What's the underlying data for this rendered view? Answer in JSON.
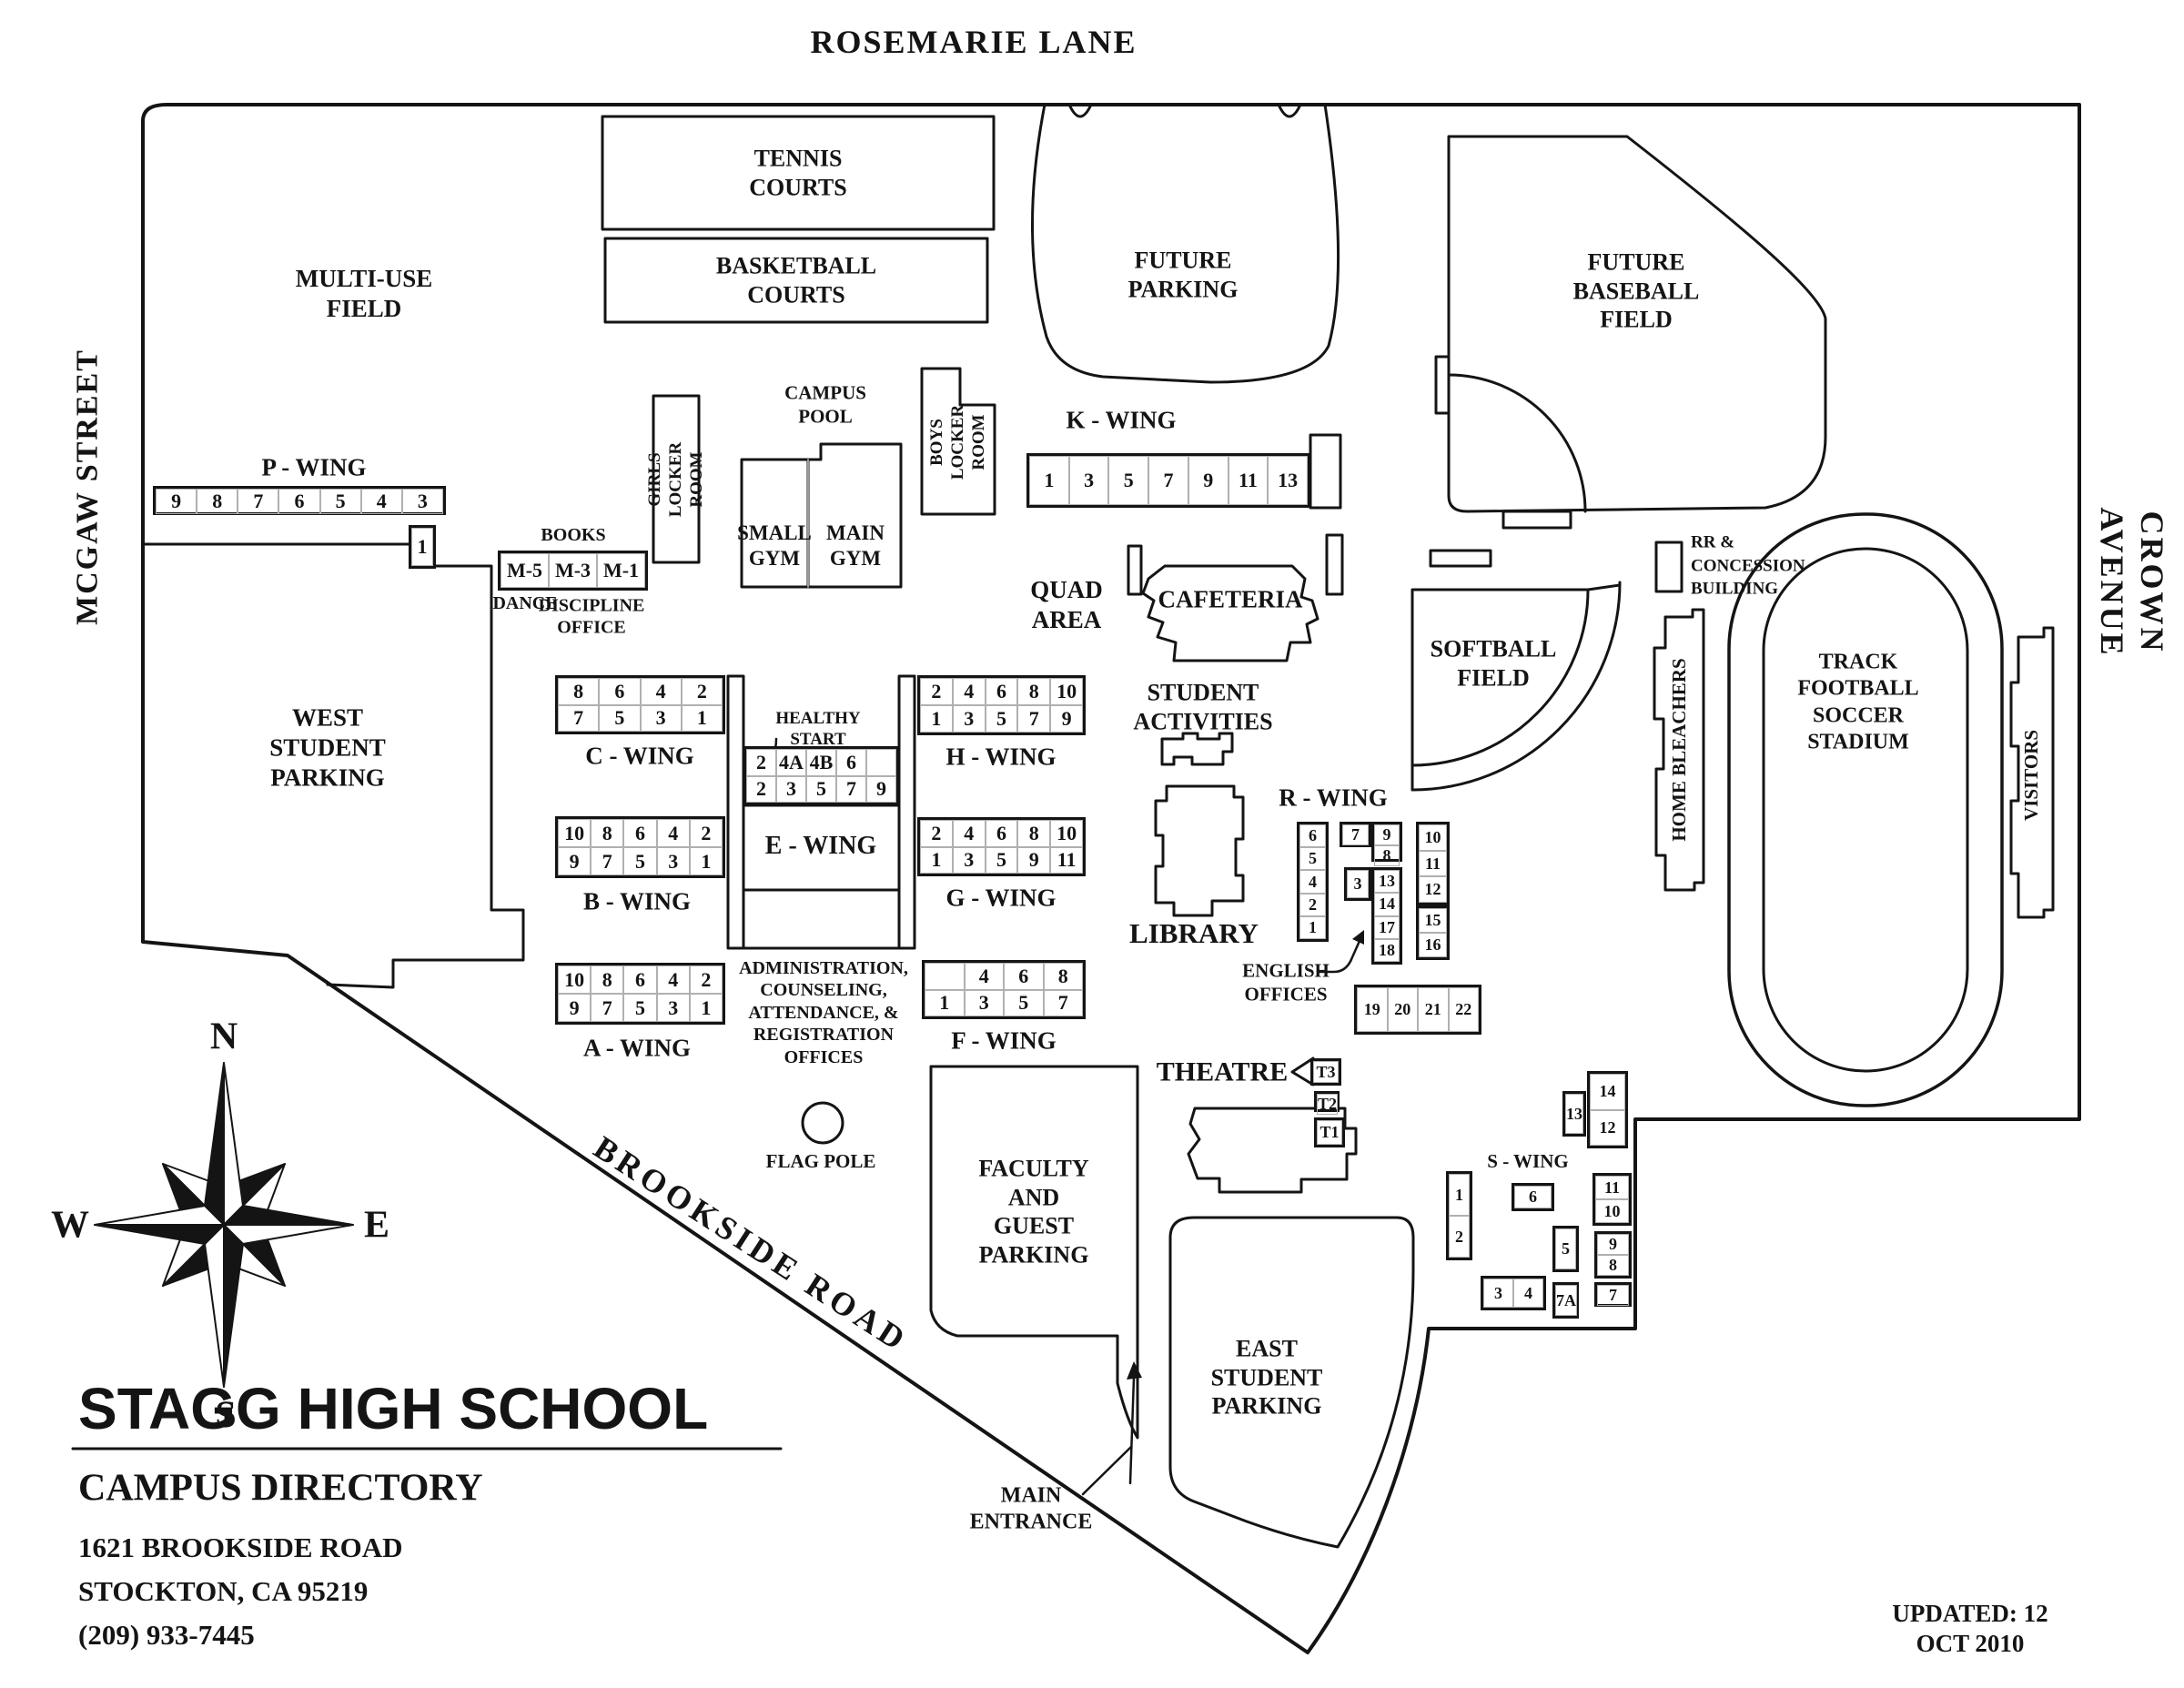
{
  "colors": {
    "ink": "#141414",
    "bg": "#ffffff"
  },
  "streets": {
    "top": "ROSEMARIE LANE",
    "left": "MCGAW STREET",
    "right": "CROWN AVENUE",
    "diagonal": "BROOKSIDE ROAD"
  },
  "compass": {
    "n": "N",
    "e": "E",
    "s": "S",
    "w": "W"
  },
  "title_block": {
    "school": "STAGG HIGH SCHOOL",
    "directory": "CAMPUS DIRECTORY",
    "address1": "1621 BROOKSIDE ROAD",
    "address2": "STOCKTON, CA 95219",
    "phone": "(209) 933-7445"
  },
  "updated": "UPDATED: 12 OCT 2010",
  "labels": {
    "tennis": "TENNIS\nCOURTS",
    "basketball": "BASKETBALL\nCOURTS",
    "multiuse": "MULTI-USE\nFIELD",
    "future_parking": "FUTURE\nPARKING",
    "future_baseball": "FUTURE\nBASEBALL\nFIELD",
    "campus_pool": "CAMPUS\nPOOL",
    "girls_locker": "GIRLS\nLOCKER\nROOM",
    "boys_locker": "BOYS\nLOCKER\nROOM",
    "small_gym": "SMALL\nGYM",
    "main_gym": "MAIN\nGYM",
    "books": "BOOKS",
    "dance": "DANCE",
    "discipline": "DISCIPLINE\nOFFICE",
    "quad": "QUAD\nAREA",
    "cafeteria": "CAFETERIA",
    "west_parking": "WEST\nSTUDENT\nPARKING",
    "healthy_start": "HEALTHY\nSTART",
    "student_activities": "STUDENT\nACTIVITIES",
    "library": "LIBRARY",
    "english_offices": "ENGLISH\nOFFICES",
    "softball": "SOFTBALL\nFIELD",
    "rr_concession": "RR &\nCONCESSION\nBUILDING",
    "home_bleachers": "HOME BLEACHERS",
    "stadium": "TRACK\nFOOTBALL\nSOCCER\nSTADIUM",
    "visitors": "VISITORS",
    "theatre": "THEATRE",
    "admin": "ADMINISTRATION,\nCOUNSELING,\nATTENDANCE, &\nREGISTRATION\nOFFICES",
    "flag_pole": "FLAG POLE",
    "faculty_parking": "FACULTY\nAND\nGUEST\nPARKING",
    "east_parking": "EAST\nSTUDENT\nPARKING",
    "main_entrance": "MAIN\nENTRANCE"
  },
  "wings": {
    "p": {
      "label": "P - WING",
      "rows": [
        [
          "9",
          "8",
          "7",
          "6",
          "5",
          "4",
          "3"
        ]
      ]
    },
    "p1": {
      "rows": [
        [
          "1"
        ]
      ]
    },
    "m": {
      "rows": [
        [
          "M-5",
          "M-3",
          "M-1"
        ]
      ]
    },
    "k": {
      "label": "K - WING",
      "rows": [
        [
          "1",
          "3",
          "5",
          "7",
          "9",
          "11",
          "13"
        ]
      ]
    },
    "c": {
      "label": "C - WING",
      "rows": [
        [
          "8",
          "6",
          "4",
          "2"
        ],
        [
          "7",
          "5",
          "3",
          "1"
        ]
      ]
    },
    "b": {
      "label": "B - WING",
      "rows": [
        [
          "10",
          "8",
          "6",
          "4",
          "2"
        ],
        [
          "9",
          "7",
          "5",
          "3",
          "1"
        ]
      ]
    },
    "a": {
      "label": "A - WING",
      "rows": [
        [
          "10",
          "8",
          "6",
          "4",
          "2"
        ],
        [
          "9",
          "7",
          "5",
          "3",
          "1"
        ]
      ]
    },
    "e": {
      "label": "E - WING",
      "rows": [
        [
          "2",
          "4A",
          "4B",
          "6",
          ""
        ],
        [
          "2",
          "3",
          "5",
          "7",
          "9"
        ]
      ]
    },
    "h": {
      "label": "H - WING",
      "rows": [
        [
          "2",
          "4",
          "6",
          "8",
          "10"
        ],
        [
          "1",
          "3",
          "5",
          "7",
          "9"
        ]
      ]
    },
    "g": {
      "label": "G - WING",
      "rows": [
        [
          "2",
          "4",
          "6",
          "8",
          "10"
        ],
        [
          "1",
          "3",
          "5",
          "9",
          "11"
        ]
      ]
    },
    "f": {
      "label": "F - WING",
      "rows": [
        [
          "",
          "4",
          "6",
          "8"
        ],
        [
          "1",
          "3",
          "5",
          "7"
        ]
      ]
    },
    "r": {
      "label": "R - WING",
      "left": [
        [
          "6"
        ],
        [
          "5"
        ],
        [
          "4"
        ],
        [
          "2"
        ],
        [
          "1"
        ]
      ],
      "seven": [
        [
          "7"
        ]
      ],
      "nine_eight": [
        [
          "9"
        ],
        [
          "8"
        ]
      ],
      "three": [
        [
          "3"
        ]
      ],
      "mid_col": [
        [
          "13"
        ],
        [
          "14"
        ],
        [
          "17"
        ],
        [
          "18"
        ]
      ],
      "right_top": [
        [
          "10"
        ],
        [
          "11"
        ],
        [
          "12"
        ]
      ],
      "right_mid": [
        [
          "15"
        ],
        [
          "16"
        ]
      ],
      "bottom": [
        [
          "19",
          "20",
          "21",
          "22"
        ]
      ]
    },
    "s": {
      "label": "S - WING",
      "b13": [
        [
          "13"
        ]
      ],
      "b14_12": [
        [
          "14"
        ],
        [
          "12"
        ]
      ],
      "b1_2": [
        [
          "1"
        ],
        [
          "2"
        ]
      ],
      "b6": [
        [
          "6"
        ]
      ],
      "b5": [
        [
          "5"
        ]
      ],
      "b3_4": [
        [
          "3",
          "4"
        ]
      ],
      "b7a": [
        [
          "7A"
        ]
      ],
      "b11_10": [
        [
          "11"
        ],
        [
          "10"
        ]
      ],
      "b9_8": [
        [
          "9"
        ],
        [
          "8"
        ]
      ],
      "b7": [
        [
          "7"
        ]
      ]
    },
    "theatre": {
      "t3": [
        [
          "T3"
        ]
      ],
      "t2": [
        [
          "T2"
        ]
      ],
      "t1": [
        [
          "T1"
        ]
      ]
    }
  }
}
